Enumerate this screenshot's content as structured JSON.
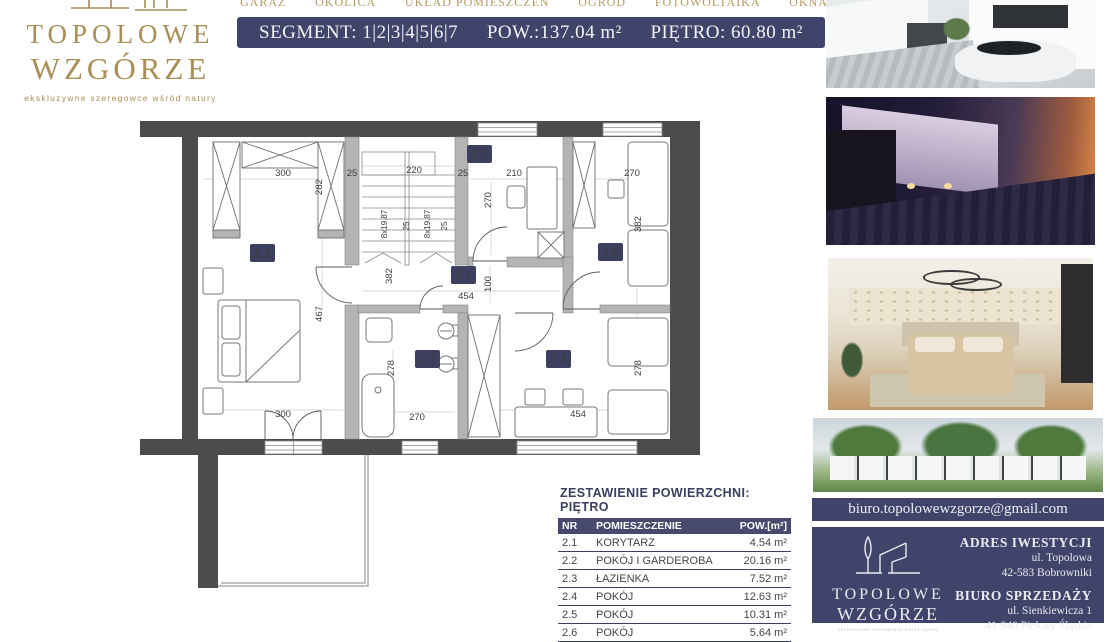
{
  "brand": {
    "name_line1": "TOPOLOWE",
    "name_line2": "WZGÓRZE",
    "tagline": "ekskluzywne szeregowce wśród natury"
  },
  "nav": {
    "items": [
      "GARAŻ",
      "OKOLICA",
      "UKŁAD POMIESZCZEŃ",
      "OGRÓD",
      "FOTOWOLTAIKA",
      "OKNA"
    ]
  },
  "header": {
    "segment": "SEGMENT: 1|2|3|4|5|6|7",
    "area": "POW.:137.04 m²",
    "floor": "PIĘTRO: 60.80 m²"
  },
  "floor_plan": {
    "rooms": {
      "r21": "2.1",
      "r22": "2.2",
      "r23": "2.3",
      "r24": "2.4",
      "r25": "2.5",
      "r26": "2.6"
    },
    "dims": {
      "top300": "300",
      "top25a": "25",
      "top220": "220",
      "top25b": "25",
      "top210": "210",
      "top270": "270",
      "v282": "282",
      "v270": "270",
      "v382right": "382",
      "stair1": "8x19.87",
      "stair2": "25",
      "stair3": "8x19.87",
      "stair4": "25",
      "v382stair": "382",
      "v467": "467",
      "v100": "100",
      "mid454": "454",
      "v278bath": "278",
      "v278room": "278",
      "bath270": "270",
      "bottom300": "300",
      "bottom454": "454"
    }
  },
  "area_table": {
    "title": "ZESTAWIENIE POWIERZCHNI: PIĘTRO",
    "columns": [
      "NR",
      "POMIESZCZENIE",
      "POW.[m²]"
    ],
    "rows": [
      {
        "nr": "2.1",
        "name": "KORYTARZ",
        "area": "4.54 m²"
      },
      {
        "nr": "2.2",
        "name": "POKÓJ I GARDEROBA",
        "area": "20.16 m²"
      },
      {
        "nr": "2.3",
        "name": "ŁAZIENKA",
        "area": "7.52 m²"
      },
      {
        "nr": "2.4",
        "name": "POKÓJ",
        "area": "12.63 m²"
      },
      {
        "nr": "2.5",
        "name": "POKÓJ",
        "area": "10.31 m²"
      },
      {
        "nr": "2.6",
        "name": "POKÓJ",
        "area": "5.64 m²"
      }
    ]
  },
  "contact": {
    "email": "biuro.topolowewzgorze@gmail.com",
    "address_title": "ADRES IWESTYCJI",
    "address_line1": "ul. Topolowa",
    "address_line2": "42-583 Bobrowniki",
    "office_title": "BIURO SPRZEDAŻY",
    "office_line1": "ul. Sienkiewicza 1",
    "office_line2": "41-940 Piekary Śląskie"
  },
  "photos": {
    "p1": "exterior-day-render",
    "p2": "townhouses-dusk-render",
    "p3": "bedroom-interior-render",
    "p4": "row-houses-elevation-render"
  },
  "colors": {
    "navy": "#41446a",
    "gold": "#a98e55",
    "wall_dark": "#4c4c4c",
    "badge_navy": "#3c3f60"
  }
}
